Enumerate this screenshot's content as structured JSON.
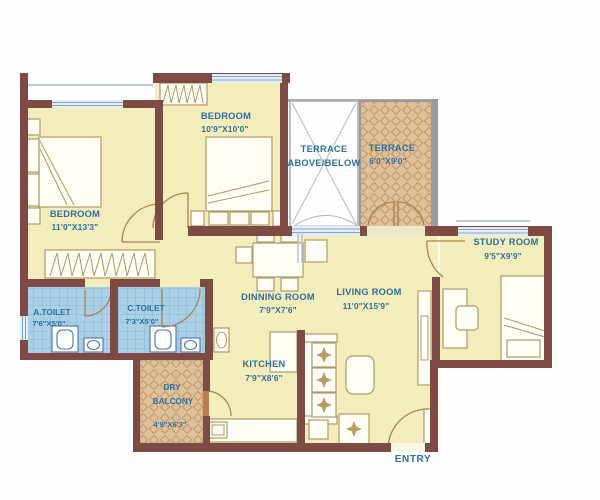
{
  "app": {
    "type": "apartment-floor-plan"
  },
  "colors": {
    "wall": "#7d4b43",
    "floor": "#f2edba",
    "label_text": "#2d6f9e",
    "toilet_tile": "#abd0e6",
    "terrace_hatch": "#dec09a",
    "window": "#7fa8c8"
  },
  "rooms": {
    "bedroom1": {
      "name": "BEDROOM",
      "dims": "11'0\"X13'3\""
    },
    "bedroom2": {
      "name": "BEDROOM",
      "dims": "10'9\"X10'0\""
    },
    "terrace_open": {
      "line1": "TERRACE",
      "line2": "ABOVE/BELOW"
    },
    "terrace": {
      "name": "TERRACE",
      "dims": "6'0\"X9'0\""
    },
    "study": {
      "name": "STUDY ROOM",
      "dims": "9'5\"X9'9\""
    },
    "dining": {
      "name": "DINNING ROOM",
      "dims": "7'9\"X7'6\""
    },
    "living": {
      "name": "LIVING ROOM",
      "dims": "11'0\"X15'9\""
    },
    "kitchen": {
      "name": "KITCHEN",
      "dims": "7'9\"X8'6\""
    },
    "a_toilet": {
      "name": "A.TOILET",
      "dims": "7'6\"X5'0\""
    },
    "c_toilet": {
      "name": "C.TOILET",
      "dims": "7'3\"X5'0\""
    },
    "dry_balcony": {
      "line1": "DRY",
      "line2": "BALCONY",
      "dims": "4'9\"X6'3\""
    }
  },
  "labels": {
    "entry": "ENTRY"
  }
}
